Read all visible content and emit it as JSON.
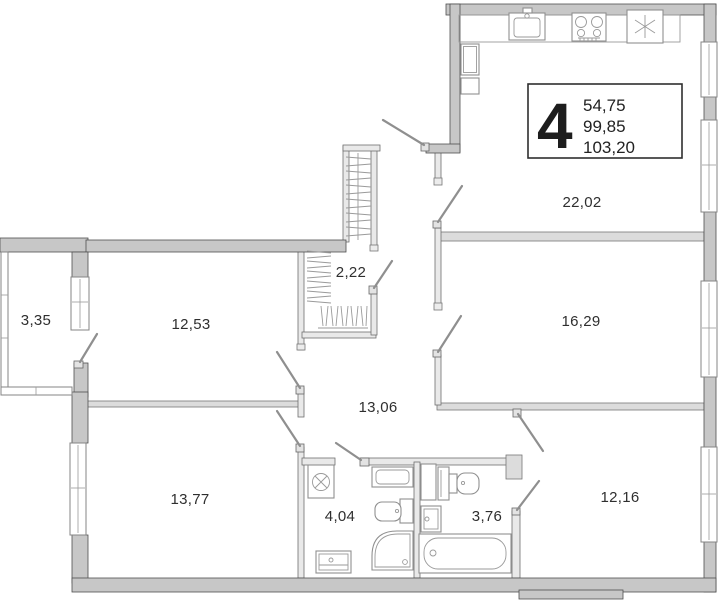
{
  "plan": {
    "info_box": {
      "rooms_count": "4",
      "values": [
        "54,75",
        "99,85",
        "103,20"
      ]
    },
    "rooms": {
      "kitchen_living": {
        "area": "22,02"
      },
      "bedroom_right": {
        "area": "16,29"
      },
      "bedroom_bottom_right": {
        "area": "12,16"
      },
      "bedroom_bottom_left": {
        "area": "13,77"
      },
      "room_left": {
        "area": "12,53"
      },
      "hallway": {
        "area": "13,06"
      },
      "wardrobe": {
        "area": "2,22"
      },
      "bathroom_left": {
        "area": "4,04"
      },
      "bathroom_right": {
        "area": "3,76"
      },
      "balcony": {
        "area": "3,35"
      }
    }
  }
}
